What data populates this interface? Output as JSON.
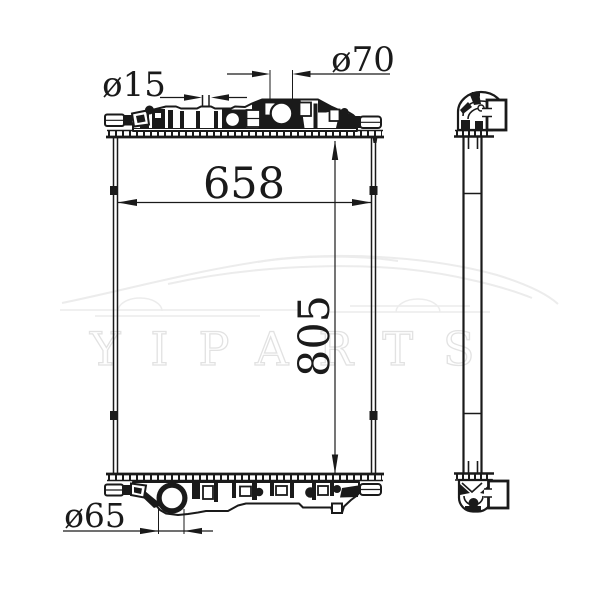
{
  "watermark": {
    "text": "YIPARTS"
  },
  "dimensions": {
    "inlet_pipe": {
      "label": "ø15",
      "value": 15
    },
    "filler_neck": {
      "label": "ø70",
      "value": 70
    },
    "core_width": {
      "label": "658",
      "value": 658
    },
    "core_height": {
      "label": "805",
      "value": 805
    },
    "outlet": {
      "label": "ø65",
      "value": 65
    }
  },
  "colors": {
    "background": "#ffffff",
    "line": "#1a1a1a",
    "watermark_outline": "#e2e2e2",
    "watermark_fill": "#ffffff"
  }
}
